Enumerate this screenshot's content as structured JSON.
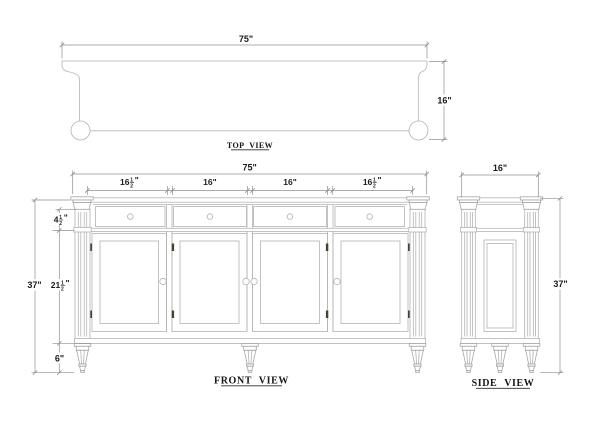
{
  "drawing": {
    "colors": {
      "object_line": "#b3b3b3",
      "dimension_line": "#8f8f8f",
      "text": "#1c1c1c",
      "hinge_mark": "#45422f",
      "background": "#ffffff"
    },
    "views": {
      "top": {
        "label": "TOP VIEW",
        "dims": {
          "width": {
            "label": "75\""
          },
          "depth": {
            "label": "16\""
          }
        }
      },
      "front": {
        "label": "FRONT VIEW",
        "dims": {
          "width": {
            "label": "75\""
          },
          "sections": [
            {
              "whole": "16",
              "num": "1",
              "den": "2",
              "unit": "\""
            },
            {
              "label": "16\""
            },
            {
              "label": "16\""
            },
            {
              "whole": "16",
              "num": "1",
              "den": "2",
              "unit": "\""
            }
          ],
          "height": {
            "label": "37\""
          },
          "drawer_height": {
            "whole": "4",
            "num": "1",
            "den": "2",
            "unit": "\""
          },
          "door_height": {
            "whole": "21",
            "num": "1",
            "den": "2",
            "unit": "\""
          },
          "leg_height": {
            "label": "6\""
          }
        }
      },
      "side": {
        "label": "SIDE VIEW",
        "dims": {
          "depth": {
            "label": "16\""
          },
          "height": {
            "label": "37\""
          }
        }
      }
    }
  }
}
